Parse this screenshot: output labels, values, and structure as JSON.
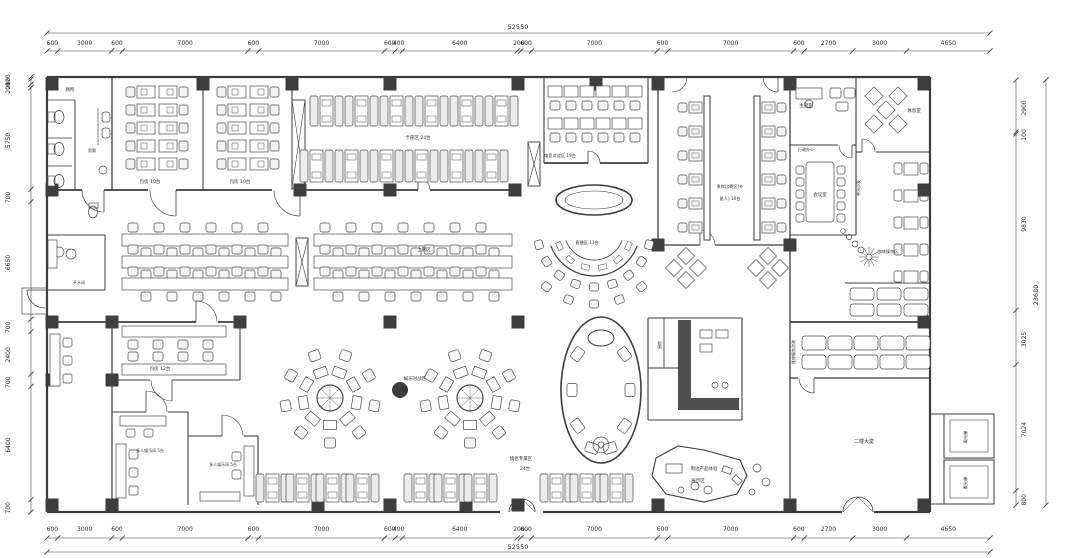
{
  "plan": {
    "total_width_top": "52550",
    "total_width_bottom": "52550",
    "total_height_right": "23680",
    "dims_top": [
      "600",
      "3000",
      "600",
      "7000",
      "600",
      "7000",
      "600",
      "400",
      "6400",
      "200",
      "600",
      "7000",
      "600",
      "7000",
      "600",
      "2700",
      "3000",
      "4650"
    ],
    "dims_bottom": [
      "600",
      "3000",
      "600",
      "7000",
      "600",
      "7000",
      "600",
      "400",
      "6400",
      "200",
      "600",
      "7000",
      "600",
      "7000",
      "600",
      "2700",
      "3000",
      "4650"
    ],
    "dims_left": [
      "120",
      "280",
      "200",
      "5750",
      "700",
      "6650",
      "700",
      "2400",
      "700",
      "6400",
      "700"
    ],
    "dims_right": [
      "2900",
      "100",
      "9830",
      "3025",
      "7024",
      "800"
    ],
    "rooms": [
      {
        "label": "厕所"
      },
      {
        "label": "男厕"
      },
      {
        "label": "包房 10台"
      },
      {
        "label": "包房 10台"
      },
      {
        "label": "卡座区 24台"
      },
      {
        "label": "电竞对战区 19台"
      },
      {
        "label": "直播区 13台"
      },
      {
        "label": "贵宾比赛区(外"
      },
      {
        "label": "星人) 10台"
      },
      {
        "label": "主管室"
      },
      {
        "label": "休息室"
      },
      {
        "label": "行政办公"
      },
      {
        "label": "会议室"
      },
      {
        "label": "茶水沙发"
      },
      {
        "label": "咖啡操作区"
      },
      {
        "label": "上网区"
      },
      {
        "label": "维修服务咨询"
      },
      {
        "label": "厨房"
      },
      {
        "label": "包房 12台"
      },
      {
        "label": "多人娱乐间 5台"
      },
      {
        "label": "多人娱乐间 5台"
      },
      {
        "label": "娱乐对战区"
      },
      {
        "label": "23台"
      },
      {
        "label": "情侣专属区"
      },
      {
        "label": "24台"
      },
      {
        "label": "周边产品体验"
      },
      {
        "label": "展示区"
      },
      {
        "label": "二楼大堂"
      },
      {
        "label": "观光梯"
      },
      {
        "label": "观光梯"
      },
      {
        "label": "开水间"
      }
    ]
  }
}
